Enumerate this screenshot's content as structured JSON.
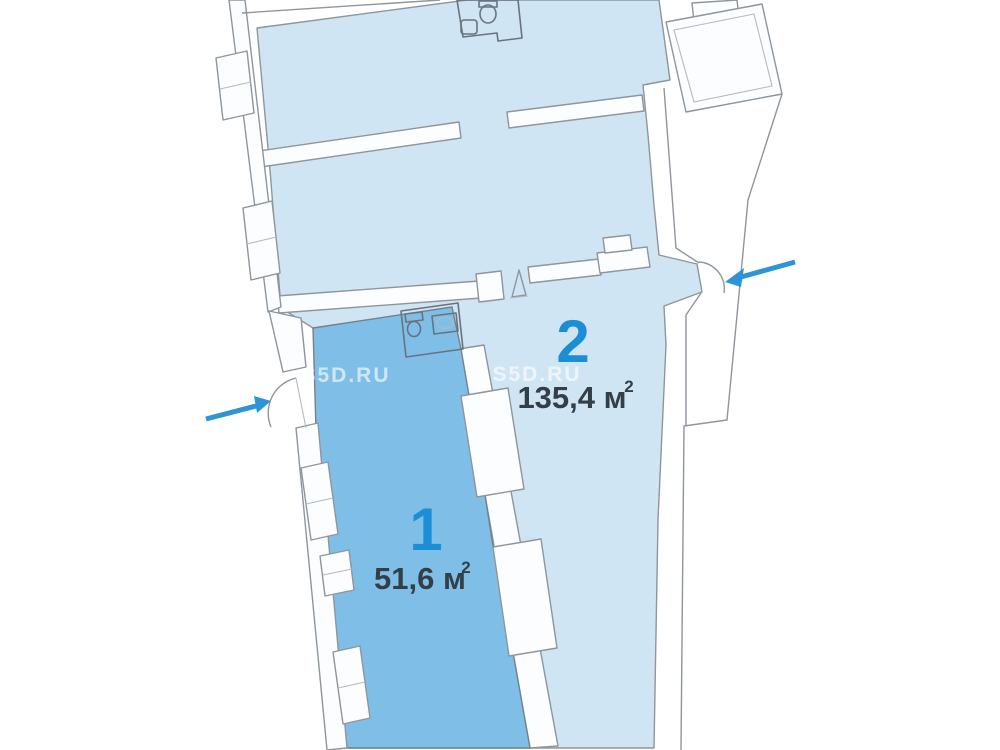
{
  "page": {
    "background_color": "#ffffff"
  },
  "plan": {
    "type": "floor-plan",
    "units": [
      {
        "number": "1",
        "area_value": "51,6 м",
        "area_superscript": "2",
        "fill_color": "#7fbfe7",
        "number_color": "#1b8ed6",
        "area_text_color": "#333e47"
      },
      {
        "number": "2",
        "area_value": "135,4 м",
        "area_superscript": "2",
        "fill_color": "#d0e5f3",
        "number_color": "#1b8ed6",
        "area_text_color": "#333e47"
      }
    ],
    "watermarks": [
      {
        "text": "S5D.RU"
      },
      {
        "text": "S5D.RU"
      }
    ],
    "entrance_arrows": {
      "color": "#2e94d8",
      "count": 2
    },
    "wall_line_color": "#8d959d"
  }
}
